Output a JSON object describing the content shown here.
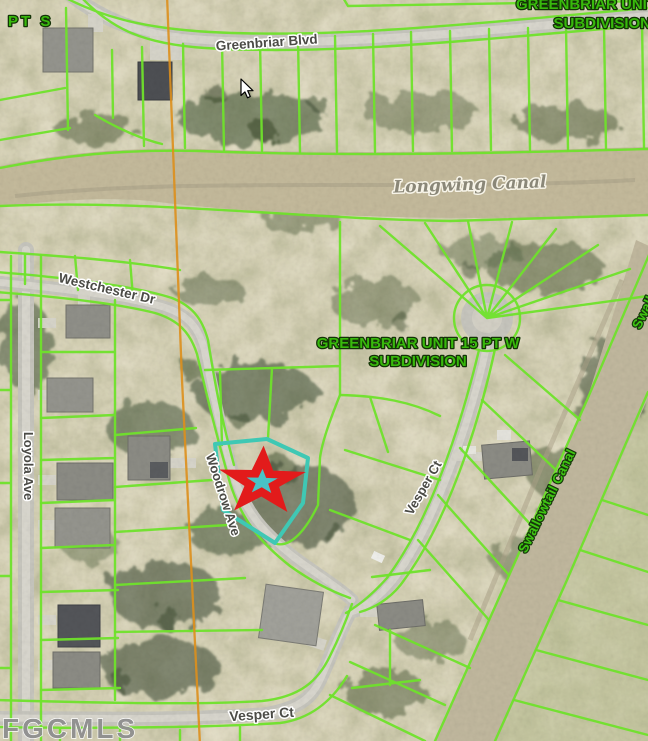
{
  "map": {
    "watermark": "FGCMLS",
    "labels": {
      "subdivision_top_left_partial": "PT S",
      "subdivision_top_right_line1": "GREENBRIAR UNIT",
      "subdivision_top_right_line2": "SUBDIVISION",
      "subdivision_center_line1": "GREENBRIAR UNIT 15 PT W",
      "subdivision_center_line2": "SUBDIVISION",
      "streets": {
        "greenbriar_blvd": "Greenbriar Blvd",
        "westchester_dr": "Westchester Dr",
        "loyola_ave": "Loyola Ave",
        "woodrow_ave": "Woodrow Ave",
        "vesper_ct_upper": "Vesper Ct",
        "vesper_ct_lower": "Vesper Ct"
      },
      "waterways": {
        "longwing_canal": "Longwing Canal",
        "swallowtail_canal": "Swallowtail Canal",
        "swallowtail_canal_partial": "Swallowtail Canal"
      }
    },
    "marker": {
      "type": "star",
      "description": "subject property star marker on highlighted parcel"
    },
    "colors": {
      "parcel_line": "#6fe22b",
      "subject_parcel_outline": "#3fc8b4",
      "star_outline": "#e21b1b",
      "star_center": "#49c2c6",
      "subdivision_label": "#38b90c",
      "street_label": "#4b4b46",
      "power_line": "#dd8f1c",
      "watermark": "#8f8f8f"
    }
  }
}
